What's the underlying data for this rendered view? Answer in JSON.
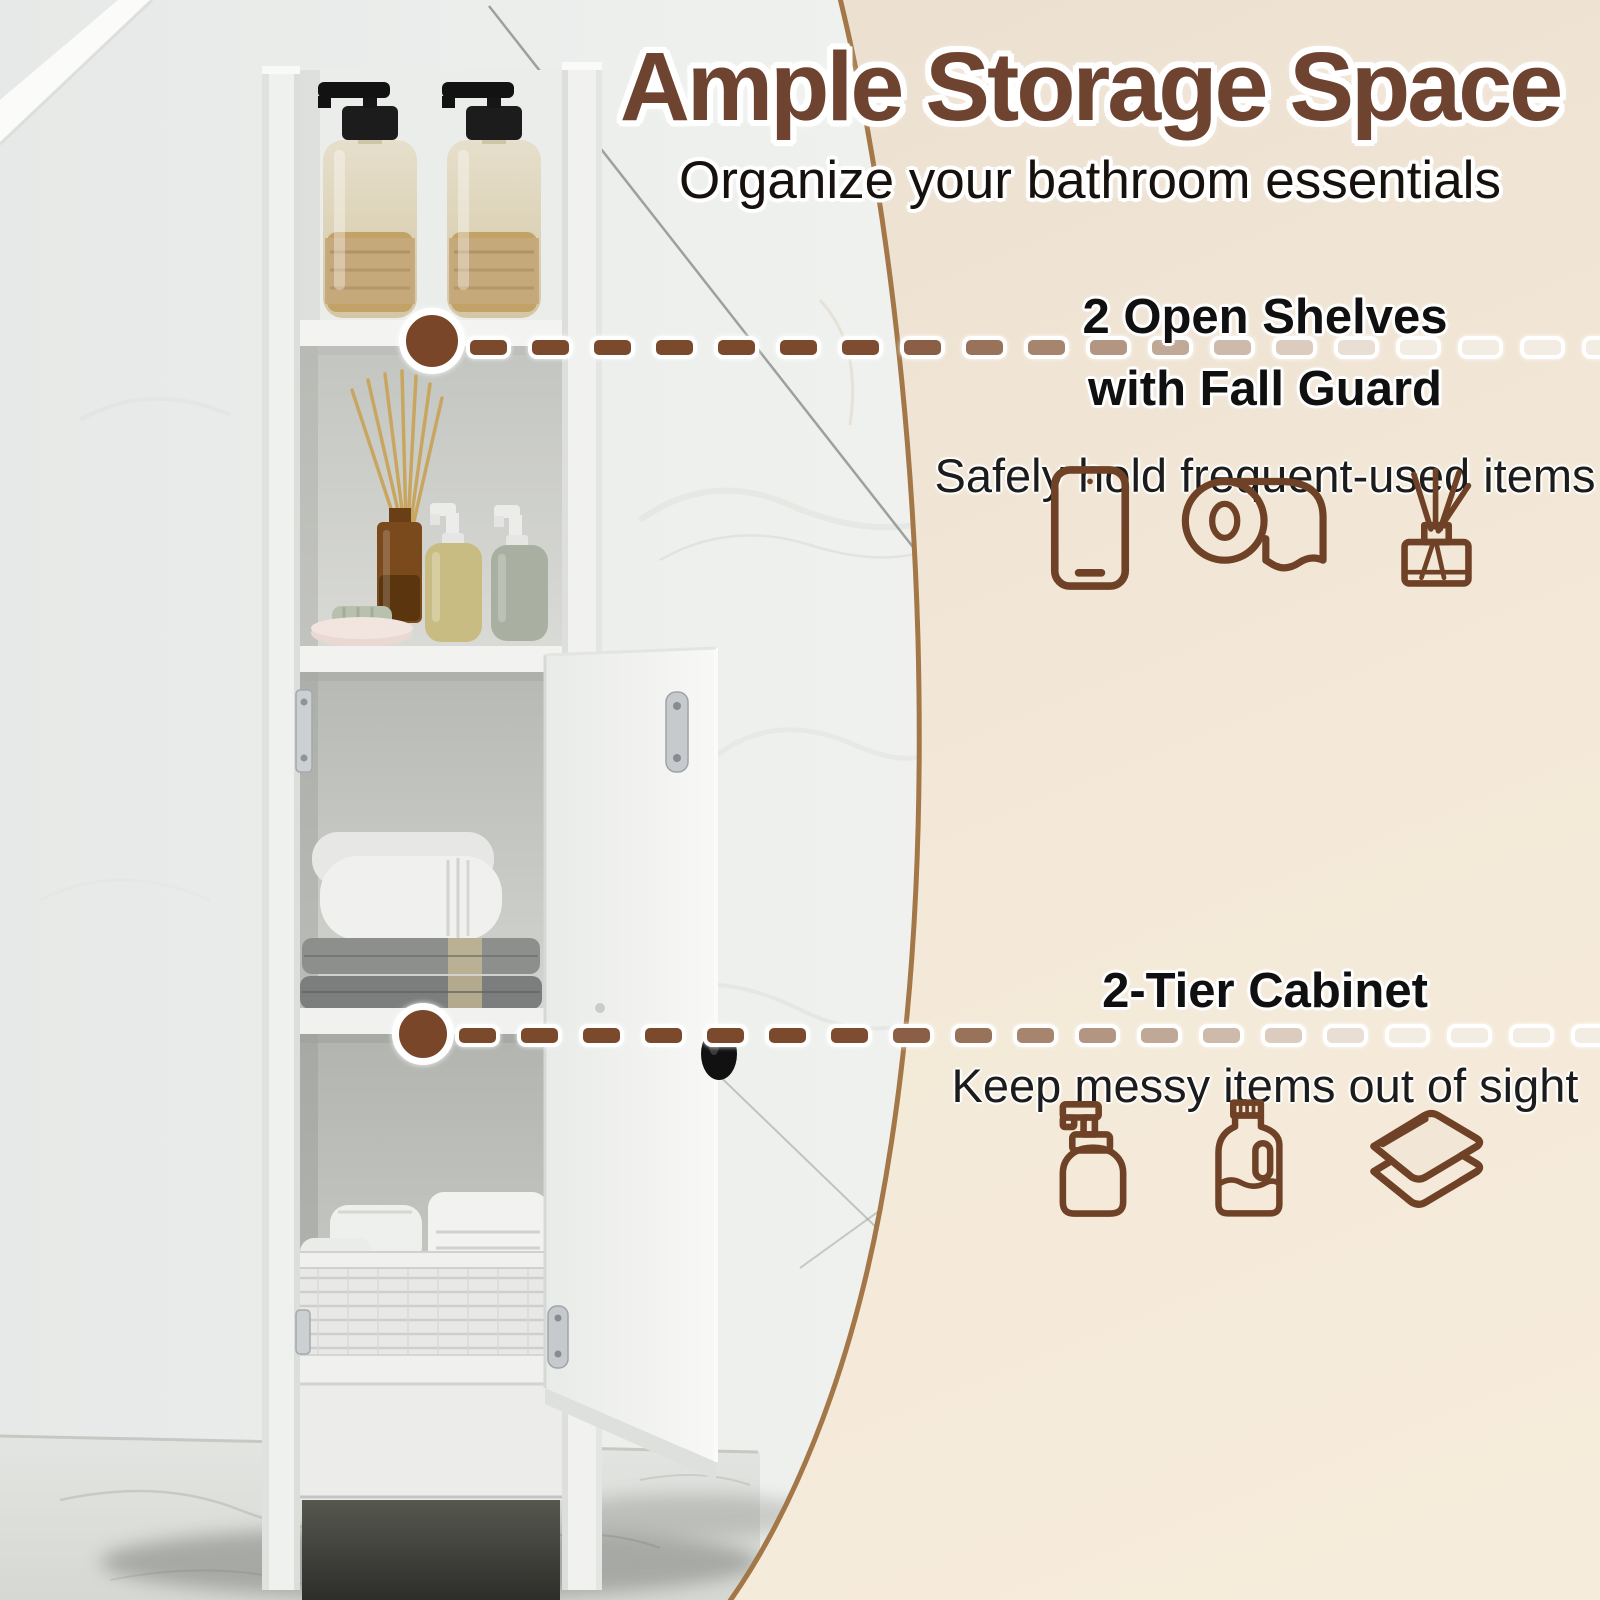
{
  "header": {
    "title": "Ample Storage Space",
    "subtitle": "Organize your bathroom essentials"
  },
  "callouts": [
    {
      "title_lines": [
        "2 Open Shelves",
        "with Fall Guard"
      ],
      "description": "Safely hold frequent-used items",
      "icons": [
        "smartphone",
        "toilet-paper-roll",
        "reed-diffuser"
      ]
    },
    {
      "title_lines": [
        "2-Tier Cabinet"
      ],
      "description": "Keep messy items out of sight",
      "icons": [
        "soap-dispenser",
        "detergent-bottle",
        "folded-towels"
      ]
    }
  ],
  "scene": {
    "objects": [
      "tall-white-bathroom-cabinet",
      "two-amber-pump-bottles",
      "reed-diffuser",
      "lotion-bottles",
      "trinket-dish",
      "folded-towels",
      "open-cabinet-door",
      "wicker-basket-with-towels",
      "marble-wall",
      "marble-floor"
    ]
  },
  "colors": {
    "title_brown": "#6E4330",
    "icon_brown": "#6F4227",
    "dot_brown": "#7A4629",
    "dash_brown": "#7B492C",
    "dash_fade": "#F2ECE3",
    "circle_fill": "#F2E7D7",
    "circle_outline": "#A37748",
    "text_black": "#141414"
  }
}
